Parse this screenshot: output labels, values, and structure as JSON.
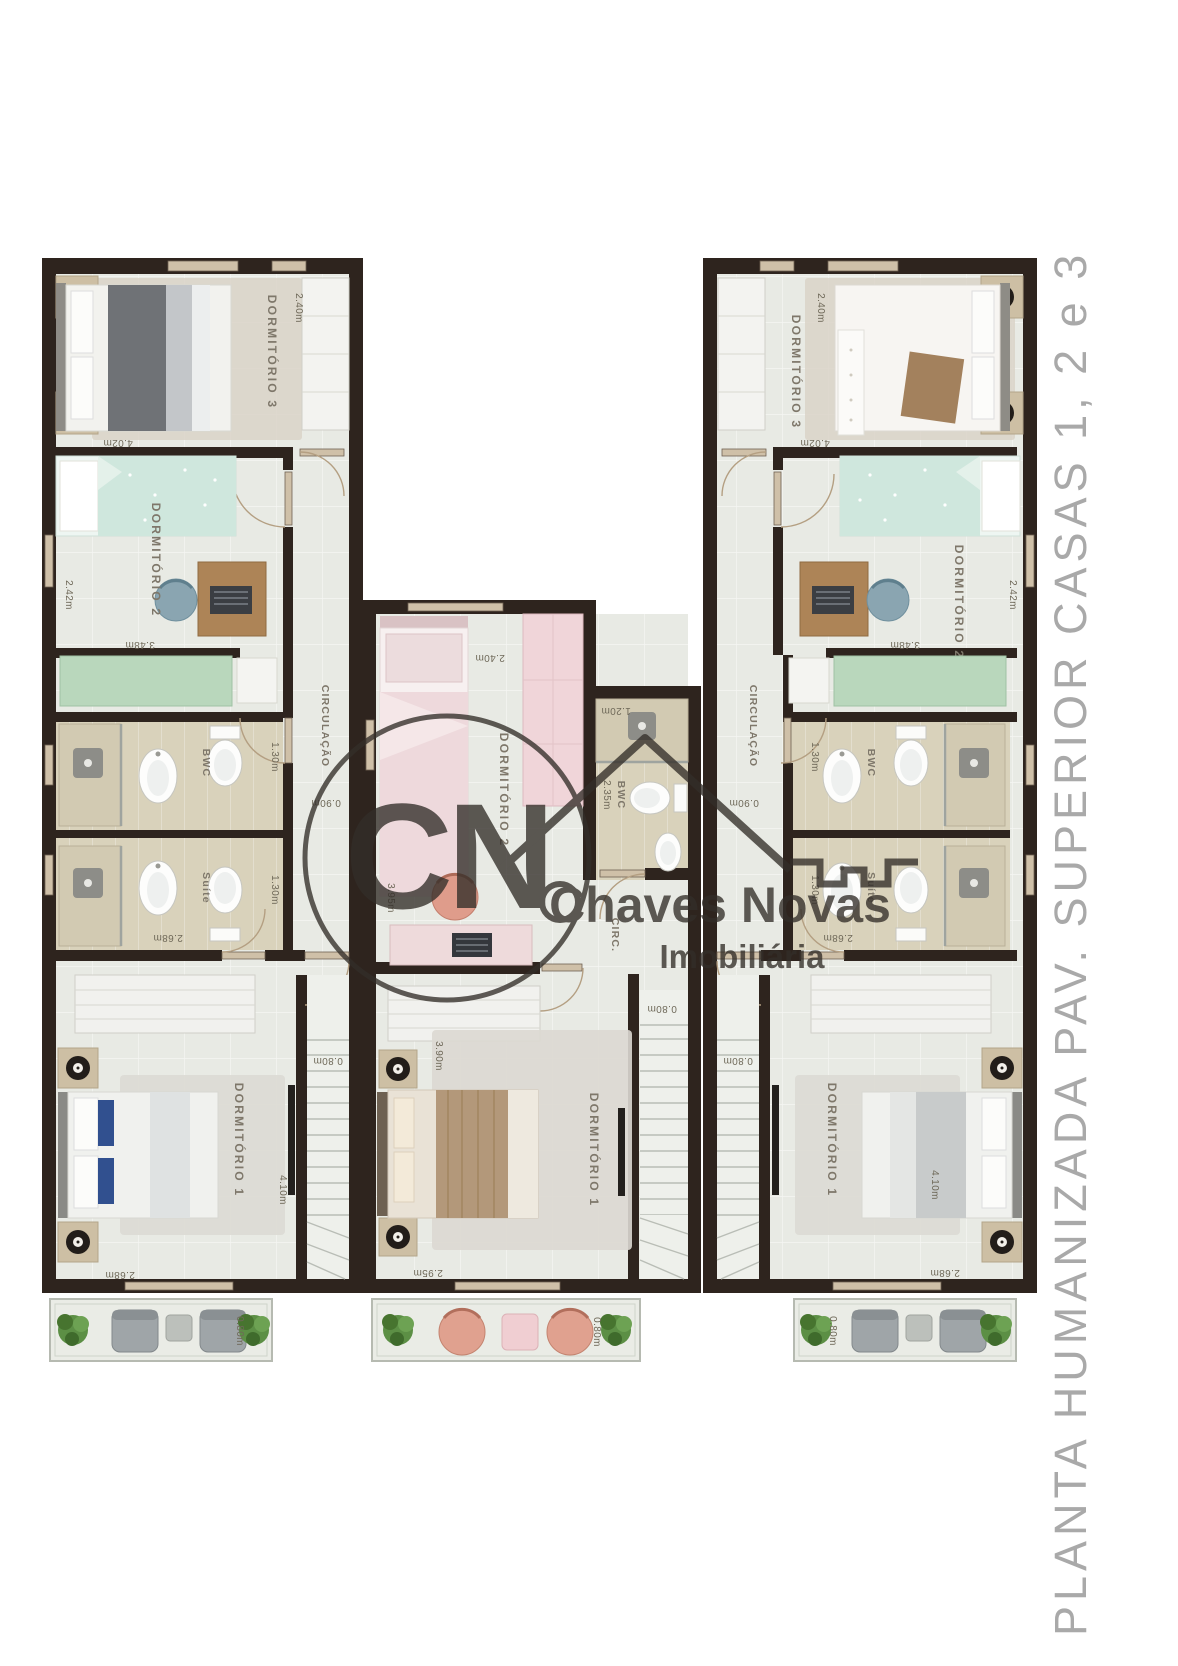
{
  "title": {
    "text": "PLANTA HUMANIZADA PAV. SUPERIOR CASAS 1, 2 e 3",
    "color": "#a9a9a9"
  },
  "watermark": {
    "monogram": "CN",
    "name": "Chaves Novas",
    "tagline": "Imobiliária",
    "color": "#332e29"
  },
  "colors": {
    "wall": "#2e241e",
    "floor": "#e8eae4",
    "bath_floor": "#d9d2bb",
    "wardrobe_green": "#b9d7bc",
    "accent_pink": "#eed9dc",
    "accent_teal": "#cfe7dd",
    "title_gray": "#a9a9a9",
    "watermark": "#332e29"
  },
  "units": {
    "casa1": {
      "dormitorio3": {
        "label": "DORMITÓRIO 3",
        "dim_depth": "2.40m",
        "dim_width": "4.02m"
      },
      "dormitorio2": {
        "label": "DORMITÓRIO 2",
        "dim_depth": "2.42m",
        "dim_width": "3.48m"
      },
      "circulacao": {
        "label": "CIRCULAÇÃO",
        "dim_width": "0.90m"
      },
      "bwc": {
        "label": "BWC",
        "dim_depth": "1.30m"
      },
      "suite": {
        "label": "Suíte",
        "dim_depth": "1.30m",
        "dim_width": "2.68m"
      },
      "dormitorio1": {
        "label": "DORMITÓRIO 1",
        "dim_depth": "4.10m",
        "dim_width": "2.68m"
      },
      "escada": {
        "dim_width": "0.80m"
      },
      "sacada": {
        "dim_depth": "0.80m"
      }
    },
    "casa2": {
      "dormitorio2": {
        "label": "DORMITÓRIO 2",
        "dim_width": "2.40m",
        "dim_depth": "3.95m"
      },
      "bwc": {
        "label": "BWC",
        "dim_depth": "2.35m",
        "dim_width": "1.20m"
      },
      "circulacao": {
        "label": "CIRC."
      },
      "dormitorio1": {
        "label": "DORMITÓRIO 1",
        "dim_depth": "3.90m",
        "dim_width": "2.95m"
      },
      "escada": {
        "dim_width": "0.80m"
      },
      "sacada": {
        "dim_depth": "0.80m"
      }
    },
    "casa3": {
      "dormitorio3": {
        "label": "DORMITÓRIO 3",
        "dim_depth": "2.40m",
        "dim_width": "4.02m"
      },
      "dormitorio2": {
        "label": "DORMITÓRIO 2",
        "dim_depth": "2.42m",
        "dim_width": "3.48m"
      },
      "circulacao": {
        "label": "CIRCULAÇÃO",
        "dim_width": "0.90m"
      },
      "bwc": {
        "label": "BWC",
        "dim_depth": "1.30m"
      },
      "suite": {
        "label": "Suíte",
        "dim_depth": "1.30m",
        "dim_width": "2.68m"
      },
      "dormitorio1": {
        "label": "DORMITÓRIO 1",
        "dim_depth": "4.10m",
        "dim_width": "2.68m"
      },
      "escada": {
        "dim_width": "0.80m"
      },
      "sacada": {
        "dim_depth": "0.80m"
      }
    }
  }
}
